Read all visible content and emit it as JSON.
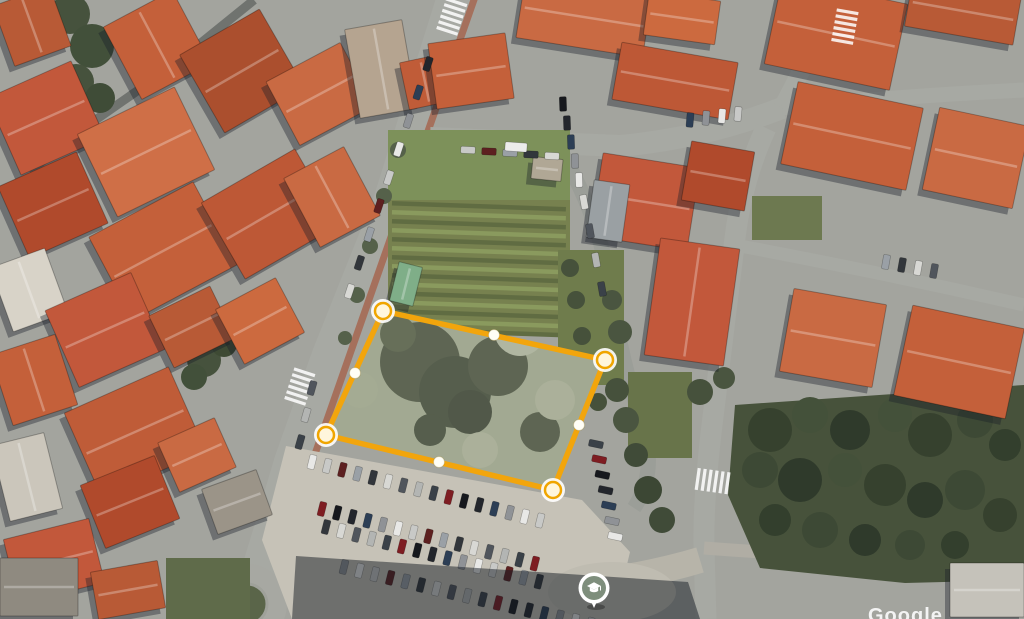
{
  "palette": {
    "ground": "#a3a49e",
    "road": "#a7a9a3",
    "building_shadow": "rgba(24,29,40,0.38)",
    "polygon_accent": "#f2a50c",
    "pin_fill": "#7e8e7c",
    "cars": [
      "#23262c",
      "#e8e8e6",
      "#9aa0a6",
      "#50555c",
      "#7e1d22",
      "#2c3e55",
      "#c8c9c7",
      "#32363b",
      "#b3b5b3",
      "#16181d",
      "#8f9296",
      "#5d2020",
      "#d8d8d4",
      "#3a4148"
    ]
  },
  "map": {
    "roads": [
      [
        "M 458,-12 L 390,205 L 330,355 L 292,462 Q 272,530 258,575",
        36,
        null
      ],
      [
        "M 258,575 Q 248,600 244,619",
        30,
        null
      ],
      [
        "M 476,-6 L 308,474",
        7,
        "#a5705c"
      ],
      [
        "M 430,138 L 620,146 Q 705,138 782,108",
        22,
        null
      ],
      [
        "M 782,108 L 840,-4",
        18,
        null
      ],
      [
        "M 782,108 Q 900,96 1024,90",
        15,
        null
      ],
      [
        "M 560,150 Q 602,220 612,300 Q 622,362 642,424 Q 658,472 634,508",
        15,
        "#9b9e98"
      ],
      [
        "M 766,128 Q 742,180 735,238 L 712,425 Q 703,500 704,548 L 706,619",
        21,
        null
      ],
      [
        "M 735,245 Q 880,272 1024,305",
        13,
        null
      ],
      [
        "M 704,548 Q 860,560 1024,560",
        13,
        "#b0ada4"
      ],
      [
        "M 290,598 Q 420,590 562,586",
        24,
        null
      ],
      [
        "M 562,586 Q 640,578 700,560",
        26,
        "#b7b4a9"
      ],
      [
        "M 254,0 L 170,68 L 84,128",
        9,
        "#70736f"
      ],
      [
        "M 84,128 L 30,172",
        8,
        "#7a7d78"
      ]
    ],
    "roundabout": {
      "cx": 247,
      "cy": 604,
      "r_outer": 40,
      "r_island": 20,
      "road_fill": "#a7a8a2",
      "island_fill": "#5a6549",
      "island_ring": "#9fa19a"
    },
    "parking": {
      "points": "286,446 582,500 630,552 614,619 292,619 262,540",
      "fill": "#c6c2b7"
    },
    "plaza": {
      "cx": 612,
      "cy": 592,
      "rx": 64,
      "ry": 30,
      "fill": "#bfbcb1"
    },
    "garden": {
      "x": 388,
      "y": 130,
      "w": 182,
      "h": 205,
      "base": "#77814f",
      "lawn": "#7d915a",
      "stripe_a": "#8a9a5e",
      "stripe_b": "#606c42"
    },
    "green_rects": [
      [
        558,
        250,
        66,
        135,
        "#6f7c4c"
      ],
      [
        628,
        372,
        64,
        86,
        "#68744a"
      ],
      [
        166,
        558,
        84,
        61,
        "#5f6b4a"
      ],
      [
        752,
        196,
        70,
        44,
        "#6d7950"
      ]
    ],
    "park": {
      "points": "735,405 1024,385 1024,580 905,583 760,568 728,495",
      "fill": "#47523b"
    },
    "tree_blobs": [
      [
        70,
        14,
        20,
        "#46523d"
      ],
      [
        92,
        46,
        22,
        "#42503a"
      ],
      [
        76,
        82,
        18,
        "#46523d"
      ],
      [
        100,
        98,
        15,
        "#3f4c37"
      ],
      [
        180,
        344,
        15,
        "#3e4a34"
      ],
      [
        204,
        360,
        17,
        "#46523d"
      ],
      [
        224,
        344,
        13,
        "#3e4a34"
      ],
      [
        194,
        377,
        13,
        "#42503a"
      ],
      [
        243,
        212,
        9,
        "#4d5a42"
      ],
      [
        258,
        227,
        8,
        "#4d5a42"
      ],
      [
        398,
        150,
        8,
        "#55614a"
      ],
      [
        384,
        196,
        8,
        "#55614a"
      ],
      [
        370,
        246,
        8,
        "#55614a"
      ],
      [
        357,
        295,
        8,
        "#55614a"
      ],
      [
        345,
        338,
        7,
        "#55614a"
      ],
      [
        612,
        300,
        10,
        "#4a5540"
      ],
      [
        620,
        332,
        12,
        "#4a5540"
      ],
      [
        617,
        390,
        12,
        "#46513c"
      ],
      [
        626,
        420,
        13,
        "#4a5540"
      ],
      [
        636,
        455,
        12,
        "#404b38"
      ],
      [
        648,
        490,
        14,
        "#3c4734"
      ],
      [
        662,
        520,
        13,
        "#404b38"
      ],
      [
        700,
        392,
        13,
        "#46513c"
      ],
      [
        724,
        378,
        11,
        "#4a5540"
      ],
      [
        570,
        268,
        9,
        "#46513b"
      ],
      [
        576,
        300,
        9,
        "#46513b"
      ],
      [
        582,
        336,
        9,
        "#46513b"
      ],
      [
        590,
        370,
        9,
        "#46513b"
      ],
      [
        598,
        402,
        9,
        "#46513b"
      ],
      [
        770,
        430,
        22,
        "#36412e"
      ],
      [
        810,
        415,
        18,
        "#44513a"
      ],
      [
        850,
        430,
        20,
        "#2f3a2b"
      ],
      [
        895,
        415,
        17,
        "#44513a"
      ],
      [
        930,
        435,
        22,
        "#36412e"
      ],
      [
        975,
        420,
        18,
        "#3d4935"
      ],
      [
        1005,
        445,
        16,
        "#333f2d"
      ],
      [
        760,
        470,
        18,
        "#3d4935"
      ],
      [
        800,
        480,
        22,
        "#2f3a2b"
      ],
      [
        845,
        470,
        17,
        "#44513a"
      ],
      [
        885,
        485,
        21,
        "#36412e"
      ],
      [
        925,
        500,
        18,
        "#2f3a2b"
      ],
      [
        965,
        490,
        20,
        "#3d4935"
      ],
      [
        1000,
        515,
        17,
        "#36412e"
      ],
      [
        775,
        520,
        16,
        "#333f2d"
      ],
      [
        820,
        530,
        18,
        "#3d4935"
      ],
      [
        865,
        540,
        16,
        "#2f3a2b"
      ],
      [
        910,
        545,
        15,
        "#3d4935"
      ],
      [
        955,
        545,
        14,
        "#333f2d"
      ]
    ],
    "buildings": [
      [
        2,
        -6,
        60,
        64,
        -20,
        "#b85a36"
      ],
      [
        118,
        4,
        78,
        82,
        -28,
        "#c4603a"
      ],
      [
        196,
        26,
        92,
        90,
        -30,
        "#ab4f2e"
      ],
      [
        278,
        58,
        84,
        72,
        -28,
        "#c96a43"
      ],
      [
        352,
        24,
        58,
        90,
        -10,
        "#b5a490"
      ],
      [
        404,
        58,
        42,
        48,
        -12,
        "#c05c38"
      ],
      [
        0,
        76,
        92,
        84,
        -24,
        "#c2583b"
      ],
      [
        92,
        106,
        108,
        92,
        -26,
        "#cf6f47"
      ],
      [
        10,
        166,
        86,
        78,
        -24,
        "#b04a2c"
      ],
      [
        104,
        204,
        118,
        94,
        -28,
        "#c4603a"
      ],
      [
        216,
        170,
        108,
        88,
        -30,
        "#bd5836"
      ],
      [
        298,
        158,
        68,
        78,
        -28,
        "#c96a43"
      ],
      [
        0,
        256,
        58,
        68,
        -20,
        "#d8d3c8"
      ],
      [
        58,
        288,
        94,
        84,
        -24,
        "#c2583b"
      ],
      [
        158,
        298,
        68,
        58,
        -26,
        "#b85a36"
      ],
      [
        226,
        290,
        68,
        62,
        -28,
        "#cc6a3f"
      ],
      [
        0,
        343,
        68,
        74,
        -18,
        "#c4603a"
      ],
      [
        78,
        386,
        114,
        92,
        -24,
        "#bf5c38"
      ],
      [
        90,
        468,
        80,
        68,
        -22,
        "#b04a2c"
      ],
      [
        0,
        438,
        54,
        78,
        -14,
        "#cbc6bb"
      ],
      [
        10,
        528,
        88,
        66,
        -14,
        "#c2583b"
      ],
      [
        166,
        428,
        62,
        54,
        -24,
        "#c96a43"
      ],
      [
        208,
        478,
        58,
        48,
        -20,
        "#9b9488"
      ],
      [
        0,
        558,
        78,
        58,
        0,
        "#8f8a80"
      ],
      [
        94,
        566,
        68,
        48,
        -10,
        "#b85a36"
      ],
      [
        432,
        38,
        78,
        66,
        -8,
        "#c4603a"
      ],
      [
        520,
        -14,
        128,
        62,
        9,
        "#c96a43"
      ],
      [
        616,
        52,
        118,
        58,
        10,
        "#bd5836"
      ],
      [
        646,
        -4,
        72,
        44,
        8,
        "#cc6a3f"
      ],
      [
        772,
        -10,
        128,
        88,
        12,
        "#c4603a"
      ],
      [
        908,
        -14,
        110,
        50,
        10,
        "#b85a36"
      ],
      [
        930,
        116,
        92,
        84,
        12,
        "#c96a43"
      ],
      [
        596,
        160,
        98,
        84,
        9,
        "#c2583b"
      ],
      [
        686,
        146,
        64,
        60,
        10,
        "#b04a2c"
      ],
      [
        788,
        94,
        128,
        84,
        12,
        "#c4603a"
      ],
      [
        652,
        243,
        80,
        118,
        8,
        "#c2583b"
      ],
      [
        786,
        296,
        94,
        84,
        10,
        "#c96a43"
      ],
      [
        902,
        316,
        114,
        92,
        12,
        "#c4603a"
      ],
      [
        950,
        563,
        74,
        54,
        0,
        "#c5c2ba"
      ],
      [
        590,
        182,
        36,
        58,
        8,
        "#9aa0a3"
      ],
      [
        532,
        158,
        30,
        22,
        6,
        "#b0a795"
      ],
      [
        394,
        264,
        24,
        40,
        14,
        "#7fae88"
      ]
    ],
    "crosswalks": [
      [
        300,
        386,
        108
      ],
      [
        452,
        16,
        108
      ],
      [
        845,
        26,
        100
      ],
      [
        712,
        481,
        8
      ]
    ],
    "car_rows": [
      [
        428,
        64,
        -9.8,
        28.4,
        9,
        108
      ],
      [
        312,
        388,
        -6,
        27,
        3,
        106
      ],
      [
        468,
        150,
        21,
        1.5,
        5,
        3
      ],
      [
        563,
        104,
        4,
        19,
        5,
        88
      ],
      [
        584,
        202,
        6,
        29,
        4,
        80
      ],
      [
        312,
        462,
        15.2,
        3.9,
        16,
        104
      ],
      [
        322,
        509,
        15.2,
        3.9,
        15,
        104
      ],
      [
        326,
        527,
        15.2,
        3.9,
        15,
        104
      ],
      [
        344,
        567,
        15.4,
        3.6,
        17,
        104
      ],
      [
        596,
        444,
        3.2,
        15.4,
        7,
        12
      ],
      [
        886,
        262,
        16,
        3,
        4,
        100
      ],
      [
        690,
        120,
        16,
        -2,
        4,
        95
      ]
    ],
    "vans": [
      [
        516,
        147,
        22,
        9,
        4,
        "#ececea"
      ]
    ],
    "shadow_polys": [
      [
        "296,556 688,582 700,619 292,619",
        "rgba(22,27,36,0.5)"
      ]
    ],
    "lot": {
      "base": "#98a086",
      "blobs": [
        [
          420,
          362,
          40,
          "#4c5440"
        ],
        [
          455,
          392,
          36,
          "#434c39"
        ],
        [
          498,
          366,
          30,
          "#4c5440"
        ],
        [
          398,
          334,
          18,
          "#565f47"
        ],
        [
          470,
          412,
          22,
          "#3e4635"
        ],
        [
          540,
          432,
          20,
          "#4c5440"
        ],
        [
          468,
          306,
          14,
          "#565f47"
        ],
        [
          430,
          430,
          16,
          "#434c39"
        ],
        [
          520,
          330,
          26,
          "#a8ae97"
        ],
        [
          555,
          400,
          20,
          "#a2a88f"
        ],
        [
          360,
          390,
          18,
          "#9aa287"
        ],
        [
          480,
          450,
          18,
          "#a2a88f"
        ]
      ]
    }
  },
  "overlay": {
    "polygon": {
      "stroke": "#f2a50c",
      "stroke_width": 5.5,
      "haze_fill": "rgba(255,255,255,0.10)",
      "vertices": [
        [
          383,
          311
        ],
        [
          605,
          360
        ],
        [
          553,
          490
        ],
        [
          326,
          435
        ]
      ],
      "midpoints": [
        [
          494,
          335
        ],
        [
          579,
          425
        ],
        [
          439,
          462
        ],
        [
          355,
          373
        ]
      ],
      "vertex_fill": "#fff6dc",
      "vertex_ring": "#f0a500",
      "midpoint_fill": "#fffef6"
    },
    "pin": {
      "x": 594,
      "y": 588,
      "fill": "#7e8e7c",
      "ring": "#ffffff",
      "icon": "graduation-cap"
    },
    "watermark": {
      "text": "Google"
    }
  }
}
